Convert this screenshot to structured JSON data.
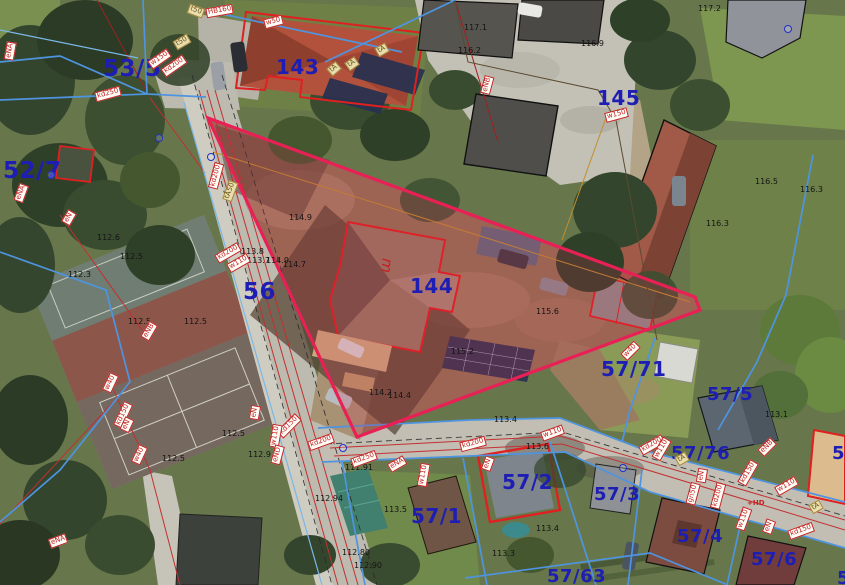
{
  "map": {
    "type": "cadastral-aerial-map",
    "highlighted_parcel": "144"
  },
  "colors": {
    "parcel_label": "#1e1eb4",
    "elevation": "#141414",
    "utility_tag": "#c22222",
    "highlight_stroke": "#e82055",
    "building_outline": "#e02020",
    "boundary_blue": "#4e94e0"
  },
  "parcel_labels": [
    {
      "text": "53/5",
      "x": 103,
      "y": 58,
      "size": 23
    },
    {
      "text": "52/7",
      "x": 3,
      "y": 160,
      "size": 23
    },
    {
      "text": "56",
      "x": 243,
      "y": 281,
      "size": 23
    },
    {
      "text": "143",
      "x": 276,
      "y": 57,
      "size": 20
    },
    {
      "text": "144",
      "x": 410,
      "y": 276,
      "size": 20
    },
    {
      "text": "145",
      "x": 597,
      "y": 88,
      "size": 20
    },
    {
      "text": "57/71",
      "x": 601,
      "y": 359,
      "size": 20
    },
    {
      "text": "57/5",
      "x": 707,
      "y": 386,
      "size": 18
    },
    {
      "text": "57/76",
      "x": 671,
      "y": 445,
      "size": 18
    },
    {
      "text": "57/1",
      "x": 411,
      "y": 506,
      "size": 20
    },
    {
      "text": "57/2",
      "x": 502,
      "y": 472,
      "size": 20
    },
    {
      "text": "57/3",
      "x": 594,
      "y": 486,
      "size": 18
    },
    {
      "text": "57/4",
      "x": 677,
      "y": 528,
      "size": 18
    },
    {
      "text": "57/6",
      "x": 751,
      "y": 551,
      "size": 18
    },
    {
      "text": "57/63",
      "x": 547,
      "y": 568,
      "size": 18
    },
    {
      "text": "57",
      "x": 832,
      "y": 445,
      "size": 18
    },
    {
      "text": "5",
      "x": 837,
      "y": 570,
      "size": 18
    }
  ],
  "elevation_labels": [
    {
      "text": "117.1",
      "x": 464,
      "y": 24
    },
    {
      "text": "116.2",
      "x": 458,
      "y": 47
    },
    {
      "text": "116.9",
      "x": 581,
      "y": 40
    },
    {
      "text": "117.2",
      "x": 698,
      "y": 5
    },
    {
      "text": "116.5",
      "x": 755,
      "y": 178
    },
    {
      "text": "116.3",
      "x": 800,
      "y": 186
    },
    {
      "text": "116.3",
      "x": 706,
      "y": 220
    },
    {
      "text": "115.6",
      "x": 536,
      "y": 308
    },
    {
      "text": "115.2",
      "x": 451,
      "y": 348
    },
    {
      "text": "114.9",
      "x": 289,
      "y": 214
    },
    {
      "text": "113.8",
      "x": 241,
      "y": 248
    },
    {
      "text": "113.7",
      "x": 247,
      "y": 257
    },
    {
      "text": "114.9",
      "x": 266,
      "y": 257
    },
    {
      "text": "114.7",
      "x": 283,
      "y": 261
    },
    {
      "text": "114.2",
      "x": 369,
      "y": 389
    },
    {
      "text": "114.4",
      "x": 388,
      "y": 392
    },
    {
      "text": "113.6",
      "x": 526,
      "y": 443
    },
    {
      "text": "113.4",
      "x": 494,
      "y": 416
    },
    {
      "text": "113.5",
      "x": 384,
      "y": 506
    },
    {
      "text": "113.4",
      "x": 536,
      "y": 525
    },
    {
      "text": "113.3",
      "x": 492,
      "y": 550
    },
    {
      "text": "113.1",
      "x": 765,
      "y": 411
    },
    {
      "text": "112.94",
      "x": 315,
      "y": 495
    },
    {
      "text": "112.80",
      "x": 342,
      "y": 549
    },
    {
      "text": "112.90",
      "x": 354,
      "y": 562
    },
    {
      "text": "112.5",
      "x": 120,
      "y": 253
    },
    {
      "text": "112.5",
      "x": 128,
      "y": 318
    },
    {
      "text": "112.5",
      "x": 184,
      "y": 318
    },
    {
      "text": "112.5",
      "x": 222,
      "y": 430
    },
    {
      "text": "112.5",
      "x": 162,
      "y": 455
    },
    {
      "text": "112.3",
      "x": 68,
      "y": 271
    },
    {
      "text": "112.6",
      "x": 97,
      "y": 234
    },
    {
      "text": "112.9",
      "x": 248,
      "y": 451
    },
    {
      "text": "111.91",
      "x": 345,
      "y": 464
    }
  ],
  "utility_tags": [
    {
      "text": "eNA",
      "x": 1,
      "y": 46,
      "rot": -80
    },
    {
      "text": "w150",
      "x": 148,
      "y": 54,
      "rot": -35
    },
    {
      "text": "kd200",
      "x": 161,
      "y": 61,
      "rot": -35
    },
    {
      "text": "kd250",
      "x": 95,
      "y": 89,
      "rot": -15
    },
    {
      "text": "t50",
      "x": 174,
      "y": 37,
      "rot": -30,
      "style": "beige"
    },
    {
      "text": "t50",
      "x": 188,
      "y": 6,
      "rot": 20,
      "style": "beige"
    },
    {
      "text": "HB160",
      "x": 206,
      "y": 6,
      "rot": -10
    },
    {
      "text": "w50",
      "x": 264,
      "y": 17,
      "rot": -15
    },
    {
      "text": "tA",
      "x": 376,
      "y": 45,
      "rot": -30,
      "style": "beige"
    },
    {
      "text": "tA",
      "x": 346,
      "y": 59,
      "rot": -35,
      "style": "beige"
    },
    {
      "text": "tA",
      "x": 328,
      "y": 64,
      "rot": -40,
      "style": "beige"
    },
    {
      "text": "eNB",
      "x": 478,
      "y": 80,
      "rot": -75
    },
    {
      "text": "w150",
      "x": 605,
      "y": 110,
      "rot": -15
    },
    {
      "text": "kd200",
      "x": 203,
      "y": 171,
      "rot": -75
    },
    {
      "text": "tA50",
      "x": 220,
      "y": 186,
      "rot": -70,
      "style": "beige"
    },
    {
      "text": "eNA",
      "x": 12,
      "y": 188,
      "rot": -70
    },
    {
      "text": "eN",
      "x": 62,
      "y": 213,
      "rot": -60
    },
    {
      "text": "kd200",
      "x": 215,
      "y": 248,
      "rot": -30
    },
    {
      "text": "w110",
      "x": 227,
      "y": 258,
      "rot": -30
    },
    {
      "text": "eNB",
      "x": 140,
      "y": 326,
      "rot": -60
    },
    {
      "text": "w40",
      "x": 101,
      "y": 378,
      "rot": -65
    },
    {
      "text": "kd150",
      "x": 110,
      "y": 410,
      "rot": -65
    },
    {
      "text": "eN",
      "x": 120,
      "y": 420,
      "rot": -65
    },
    {
      "text": "w40",
      "x": 130,
      "y": 450,
      "rot": -65
    },
    {
      "text": "eNA",
      "x": 49,
      "y": 536,
      "rot": -20
    },
    {
      "text": "eN",
      "x": 248,
      "y": 408,
      "rot": -80
    },
    {
      "text": "kd150",
      "x": 276,
      "y": 421,
      "rot": -45
    },
    {
      "text": "w110",
      "x": 264,
      "y": 431,
      "rot": -80
    },
    {
      "text": "eND",
      "x": 268,
      "y": 450,
      "rot": -75
    },
    {
      "text": "kd200",
      "x": 308,
      "y": 437,
      "rot": -20
    },
    {
      "text": "kd250",
      "x": 351,
      "y": 454,
      "rot": -20
    },
    {
      "text": "eNA",
      "x": 388,
      "y": 459,
      "rot": -30
    },
    {
      "text": "w110",
      "x": 412,
      "y": 470,
      "rot": -80
    },
    {
      "text": "kd200",
      "x": 460,
      "y": 439,
      "rot": -15
    },
    {
      "text": "eN",
      "x": 481,
      "y": 459,
      "rot": -70
    },
    {
      "text": "w110",
      "x": 541,
      "y": 428,
      "rot": -20
    },
    {
      "text": "w40",
      "x": 621,
      "y": 346,
      "rot": -45
    },
    {
      "text": "kd200",
      "x": 639,
      "y": 440,
      "rot": -30
    },
    {
      "text": "w110",
      "x": 650,
      "y": 444,
      "rot": -60
    },
    {
      "text": "tA",
      "x": 676,
      "y": 454,
      "rot": -30,
      "style": "beige"
    },
    {
      "text": "kd150",
      "x": 735,
      "y": 468,
      "rot": -60
    },
    {
      "text": "eNB",
      "x": 758,
      "y": 442,
      "rot": -45
    },
    {
      "text": "w110",
      "x": 775,
      "y": 481,
      "rot": -30
    },
    {
      "text": "eN",
      "x": 695,
      "y": 471,
      "rot": -80
    },
    {
      "text": "kd200",
      "x": 705,
      "y": 491,
      "rot": -75
    },
    {
      "text": "w110",
      "x": 732,
      "y": 514,
      "rot": -70
    },
    {
      "text": "eN",
      "x": 762,
      "y": 522,
      "rot": -70
    },
    {
      "text": "kd150",
      "x": 788,
      "y": 526,
      "rot": -20
    },
    {
      "text": "tA",
      "x": 810,
      "y": 502,
      "rot": -30,
      "style": "beige"
    },
    {
      "text": "gn50",
      "x": 682,
      "y": 489,
      "rot": -75
    },
    {
      "text": "+HD",
      "x": 746,
      "y": 500,
      "rot": 0,
      "style": "plain"
    }
  ],
  "annotations": [
    {
      "text": "m",
      "x": 379,
      "y": 258,
      "rot": 95,
      "size": 15
    }
  ],
  "symbols": [
    {
      "type": "hydrant",
      "x": 155,
      "y": 134
    },
    {
      "type": "hydrant",
      "x": 207,
      "y": 153
    },
    {
      "type": "hydrant",
      "x": 784,
      "y": 25
    },
    {
      "type": "hydrant",
      "x": 339,
      "y": 444
    },
    {
      "type": "hydrant",
      "x": 47,
      "y": 171
    },
    {
      "type": "hydrant",
      "x": 619,
      "y": 464
    }
  ]
}
